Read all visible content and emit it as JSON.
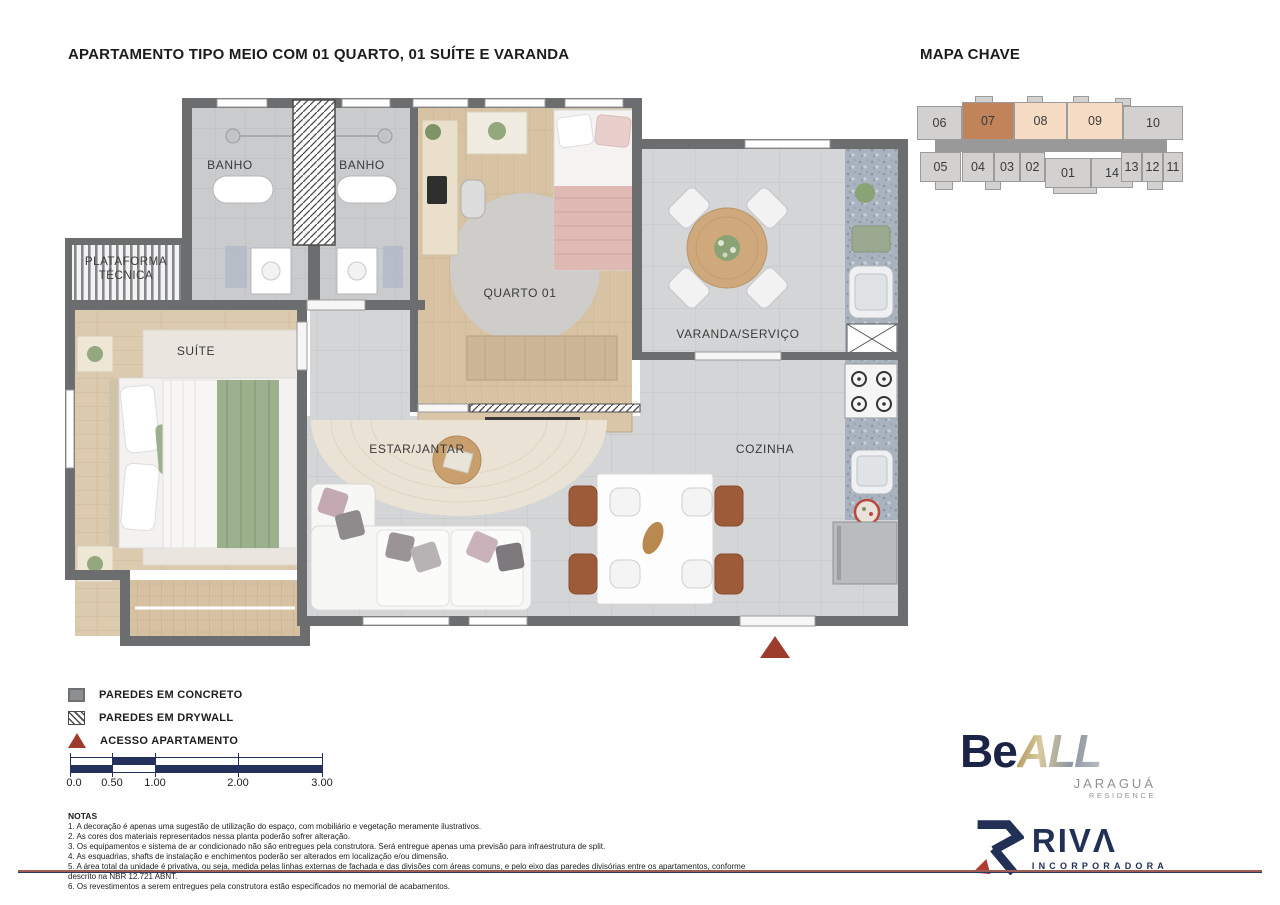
{
  "page": {
    "title": "APARTAMENTO TIPO MEIO COM 01 QUARTO, 01 SUÍTE E VARANDA"
  },
  "mapa_chave": {
    "title": "MAPA CHAVE",
    "units": [
      {
        "label": "06",
        "state": "normal"
      },
      {
        "label": "07",
        "state": "highlighted"
      },
      {
        "label": "08",
        "state": "adjacent"
      },
      {
        "label": "09",
        "state": "adjacent"
      },
      {
        "label": "10",
        "state": "normal"
      },
      {
        "label": "05",
        "state": "normal"
      },
      {
        "label": "04",
        "state": "normal"
      },
      {
        "label": "03",
        "state": "normal"
      },
      {
        "label": "02",
        "state": "normal"
      },
      {
        "label": "01",
        "state": "normal"
      },
      {
        "label": "14",
        "state": "normal"
      },
      {
        "label": "13",
        "state": "normal"
      },
      {
        "label": "12",
        "state": "normal"
      },
      {
        "label": "11",
        "state": "normal"
      }
    ]
  },
  "rooms": {
    "banho1": "BANHO",
    "banho2": "BANHO",
    "quarto": "QUARTO 01",
    "varanda": "VARANDA/SERVIÇO",
    "plataforma_line1": "PLATAFORMA",
    "plataforma_line2": "TÉCNICA",
    "suite": "SUÍTE",
    "estar": "ESTAR/JANTAR",
    "cozinha": "COZINHA"
  },
  "legend": {
    "items": [
      {
        "icon": "concrete-swatch",
        "label": "PAREDES EM CONCRETO"
      },
      {
        "icon": "drywall-swatch",
        "label": "PAREDES EM DRYWALL"
      },
      {
        "icon": "access-triangle",
        "label": "ACESSO APARTAMENTO"
      }
    ]
  },
  "scale": {
    "labels": [
      "0.0",
      "0.50",
      "1.00",
      "2.00",
      "3.00"
    ]
  },
  "notas": {
    "title": "NOTAS",
    "lines": [
      "1. A decoração é apenas uma sugestão de utilização do espaço, com mobiliário e vegetação meramente ilustrativos.",
      "2. As cores dos materiais representados nessa planta poderão sofrer alteração.",
      "3. Os equipamentos e sistema de ar condicionado não são entregues pela construtora. Será entregue apenas uma previsão para infraestrutura de split.",
      "4. As esquadrias, shafts de instalação e enchimentos poderão ser alterados em localização e/ou dimensão.",
      "5. A área total da unidade é privativa, ou seja, medida pelas linhas externas de fachada e das divisões com áreas comuns, e pelo eixo das paredes divisórias entre os apartamentos, conforme descrito na NBR 12.721 ABNT.",
      "6. Os revestimentos a serem entregues pela construtora estão especificados no memorial de acabamentos."
    ]
  },
  "logos": {
    "beall": {
      "be": "Be",
      "all": "ALL",
      "sub1": "JARAGUÁ",
      "sub2": "RESIDENCE"
    },
    "riva": {
      "name": "RIVΛ",
      "sub": "INCORPORADORA"
    }
  },
  "colors": {
    "highlighted_unit": "#c0835a",
    "adjacent_unit": "#f6dcc5",
    "normal_unit": "#d2d1d0",
    "wall_gray": "#6b6d6f",
    "scale_navy": "#24315c",
    "access_red": "#9d3c2c",
    "logo_navy": "#1b2447"
  }
}
